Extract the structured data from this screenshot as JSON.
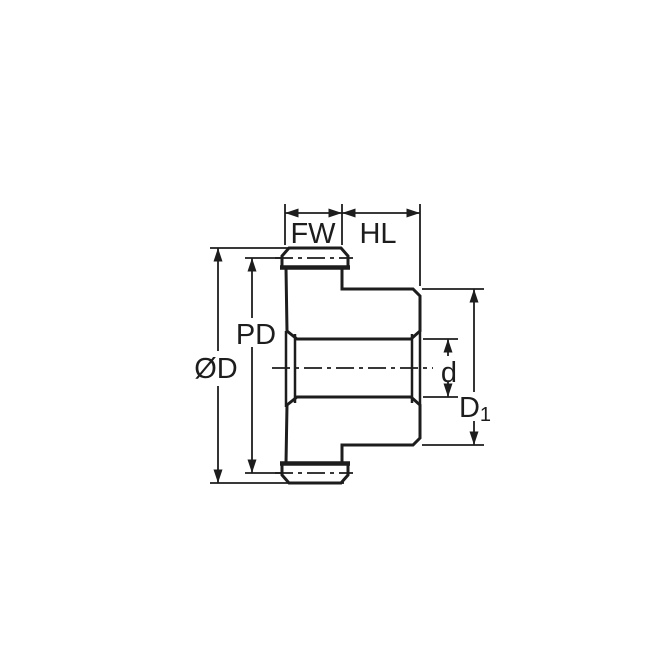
{
  "diagram": {
    "labels": {
      "face_width": "FW",
      "hub_length": "HL",
      "outside_diameter": "ØD",
      "pitch_diameter": "PD",
      "bore_diameter": "d",
      "hub_diameter": {
        "main": "D",
        "sub": "1"
      }
    },
    "colors": {
      "gear_fill": "#C6E7F7",
      "line": "#1D1D1D",
      "background": "#FFFFFF"
    }
  }
}
